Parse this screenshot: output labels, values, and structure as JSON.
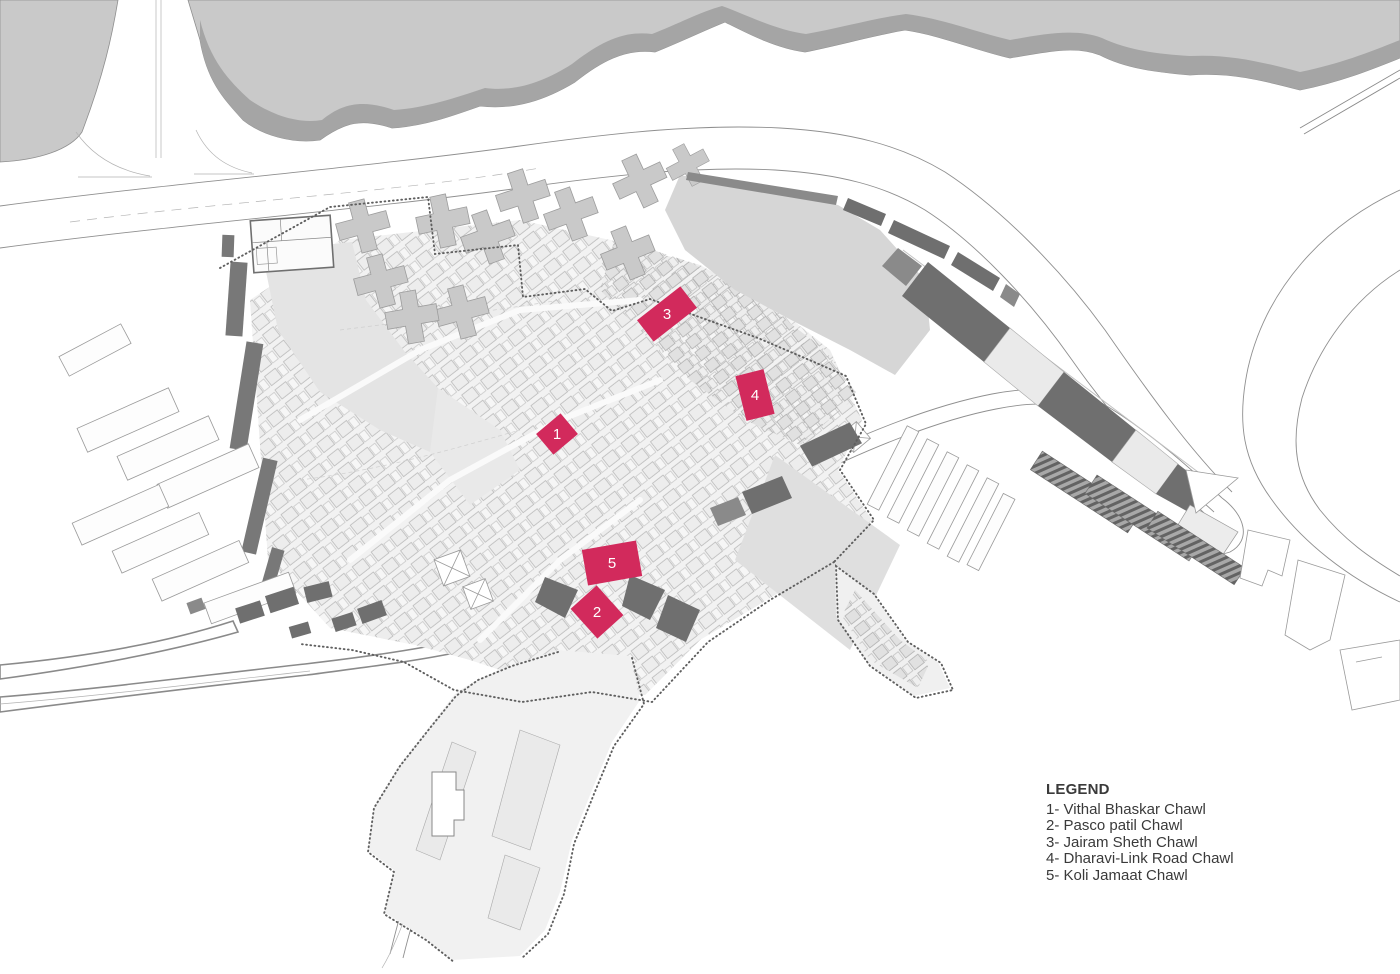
{
  "legend": {
    "title": "LEGEND",
    "items": [
      {
        "number": "1",
        "name": "Vithal Bhaskar Chawl"
      },
      {
        "number": "2",
        "name": "Pasco patil Chawl"
      },
      {
        "number": "3",
        "name": "Jairam Sheth Chawl"
      },
      {
        "number": "4",
        "name": "Dharavi-Link Road Chawl"
      },
      {
        "number": "5",
        "name": "Koli Jamaat Chawl"
      }
    ]
  },
  "map": {
    "markers": [
      {
        "label": "1",
        "x": 557,
        "y": 434,
        "w": 32,
        "h": 27,
        "rotate": -40
      },
      {
        "label": "2",
        "x": 597,
        "y": 612,
        "w": 35,
        "h": 40,
        "rotate": -42
      },
      {
        "label": "3",
        "x": 667,
        "y": 314,
        "w": 55,
        "h": 27,
        "rotate": -38
      },
      {
        "label": "4",
        "x": 755,
        "y": 395,
        "w": 29,
        "h": 46,
        "rotate": -14
      },
      {
        "label": "5",
        "x": 612,
        "y": 563,
        "w": 55,
        "h": 36,
        "rotate": -10
      }
    ],
    "colors": {
      "highlight": "#d22a5c",
      "marker_text": "#ffffff",
      "water": "#c9c9c9",
      "water_bank": "#a5a5a5"
    }
  }
}
